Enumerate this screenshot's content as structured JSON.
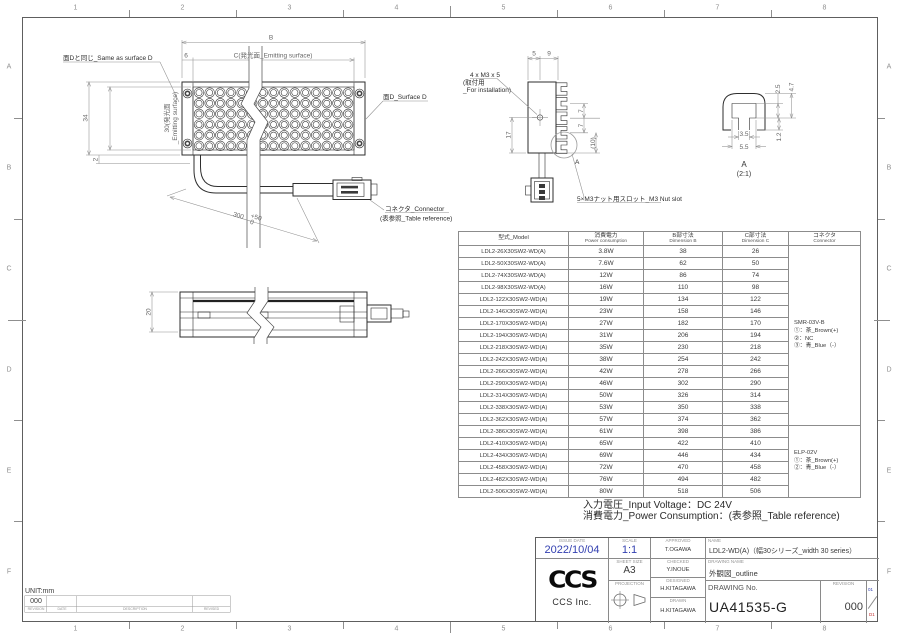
{
  "frame": {
    "cols": [
      "1",
      "2",
      "3",
      "4",
      "5",
      "6",
      "7",
      "8"
    ],
    "rows": [
      "A",
      "B",
      "C",
      "D",
      "E",
      "F"
    ]
  },
  "front_view": {
    "same_as_d": "面Dと同じ_Same as surface D",
    "dim_b": "B",
    "dim_6": "6",
    "emitting_c": "C(発光面_Emitting surface)",
    "surface_d": "面D_Surface D",
    "dim_34": "34",
    "dim_30_l1": "30(発光面",
    "dim_30_l2": "_Emitting surface)",
    "dim_2": "2",
    "cable_len": "300",
    "cable_tol_up": "+50",
    "cable_tol_dn": "0",
    "connector_l1": "コネクタ_Connector",
    "connector_l2": "(表参照_Table reference)"
  },
  "side_view": {
    "dim_20": "20"
  },
  "profile_view": {
    "dim_5": "5",
    "dim_9": "9",
    "m3_l1": "4 x M3 x 5",
    "m3_l2": "(取付用",
    "m3_l3": "_For installation)",
    "dim_17": "17",
    "dim_7a": "7",
    "dim_7b": "7",
    "dim_10": "(10)",
    "detail_mark": "A",
    "nut_slot": "5×M3ナット用スロット_M3 Nut slot"
  },
  "detail_view": {
    "dim_2_5": "2.5",
    "dim_4_7": "4.7",
    "dim_1_2": "1.2",
    "dim_3_5": "3.5",
    "dim_5_5": "5.5",
    "label": "A",
    "scale": "(2:1)"
  },
  "table": {
    "headers": {
      "model": "型式_Model",
      "power_l1": "消費電力",
      "power_l2": "Power consumption",
      "dim_b_l1": "B部寸法",
      "dim_b_l2": "Dimension B",
      "dim_c_l1": "C部寸法",
      "dim_c_l2": "Dimension C",
      "conn_l1": "コネクタ",
      "conn_l2": "Connector"
    },
    "rows": [
      [
        "LDL2-26X30SW2-WD(A)",
        "3.8W",
        "38",
        "26"
      ],
      [
        "LDL2-50X30SW2-WD(A)",
        "7.6W",
        "62",
        "50"
      ],
      [
        "LDL2-74X30SW2-WD(A)",
        "12W",
        "86",
        "74"
      ],
      [
        "LDL2-98X30SW2-WD(A)",
        "16W",
        "110",
        "98"
      ],
      [
        "LDL2-122X30SW2-WD(A)",
        "19W",
        "134",
        "122"
      ],
      [
        "LDL2-146X30SW2-WD(A)",
        "23W",
        "158",
        "146"
      ],
      [
        "LDL2-170X30SW2-WD(A)",
        "27W",
        "182",
        "170"
      ],
      [
        "LDL2-194X30SW2-WD(A)",
        "31W",
        "206",
        "194"
      ],
      [
        "LDL2-218X30SW2-WD(A)",
        "35W",
        "230",
        "218"
      ],
      [
        "LDL2-242X30SW2-WD(A)",
        "38W",
        "254",
        "242"
      ],
      [
        "LDL2-266X30SW2-WD(A)",
        "42W",
        "278",
        "266"
      ],
      [
        "LDL2-290X30SW2-WD(A)",
        "46W",
        "302",
        "290"
      ],
      [
        "LDL2-314X30SW2-WD(A)",
        "50W",
        "326",
        "314"
      ],
      [
        "LDL2-338X30SW2-WD(A)",
        "53W",
        "350",
        "338"
      ],
      [
        "LDL2-362X30SW2-WD(A)",
        "57W",
        "374",
        "362"
      ],
      [
        "LDL2-386X30SW2-WD(A)",
        "61W",
        "398",
        "386"
      ],
      [
        "LDL2-410X30SW2-WD(A)",
        "65W",
        "422",
        "410"
      ],
      [
        "LDL2-434X30SW2-WD(A)",
        "69W",
        "446",
        "434"
      ],
      [
        "LDL2-458X30SW2-WD(A)",
        "72W",
        "470",
        "458"
      ],
      [
        "LDL2-482X30SW2-WD(A)",
        "76W",
        "494",
        "482"
      ],
      [
        "LDL2-506X30SW2-WD(A)",
        "80W",
        "518",
        "506"
      ]
    ],
    "connector_groups": [
      {
        "name": "SMR-03V-B",
        "pins": [
          "①：茶_Brown(+)",
          "②：NC",
          "③：青_Blue（-）"
        ],
        "span": 15
      },
      {
        "name": "ELP-02V",
        "pins": [
          "①：茶_Brown(+)",
          "②：青_Blue（-）"
        ],
        "span": 6
      }
    ]
  },
  "notes": {
    "line1": "入力電圧_Input Voltage：DC 24V",
    "line2": "消費電力_Power Consumption：(表参照_Table reference)"
  },
  "title_block": {
    "issue_date_label": "ISSUE DATE",
    "issue_date": "2022/10/04",
    "scale_label": "SCALE",
    "scale": "1:1",
    "sheet_size_label": "SHEET SIZE",
    "sheet_size": "A3",
    "projection_label": "PROJECTION",
    "approved_label": "APPROVED",
    "approved": "T.OGAWA",
    "checked_label": "CHECKED",
    "checked": "Y.INOUE",
    "designed_label": "DESIGNED",
    "designed": "H.KITAGAWA",
    "drawn_label": "DRAWN",
    "drawn": "H.KITAGAWA",
    "name_label": "NAME",
    "name": "LDL2-WD(A)（幅30シリーズ_width 30 series）",
    "drawing_name_label": "DRAWING NAME",
    "drawing_name": "外観図_outline",
    "drawing_no_label": "DRAWING No.",
    "drawing_no": "UA41535-G",
    "revision_label": "REVISION",
    "revision": "000",
    "sheet_top": "01",
    "sheet_bottom": "D1",
    "logo": "CCS",
    "company": "CCS Inc."
  },
  "rev_block": {
    "unit": "UNIT:mm",
    "revision": "000",
    "revision_label": "REVISION",
    "date_label": "DATE",
    "description_label": "DESCRIPTION",
    "revised_label": "REVISED"
  },
  "colors": {
    "accent_blue": "#3340b0",
    "accent_red": "#c03030",
    "line": "#2e2e2e",
    "dim": "#8f8f8f"
  }
}
